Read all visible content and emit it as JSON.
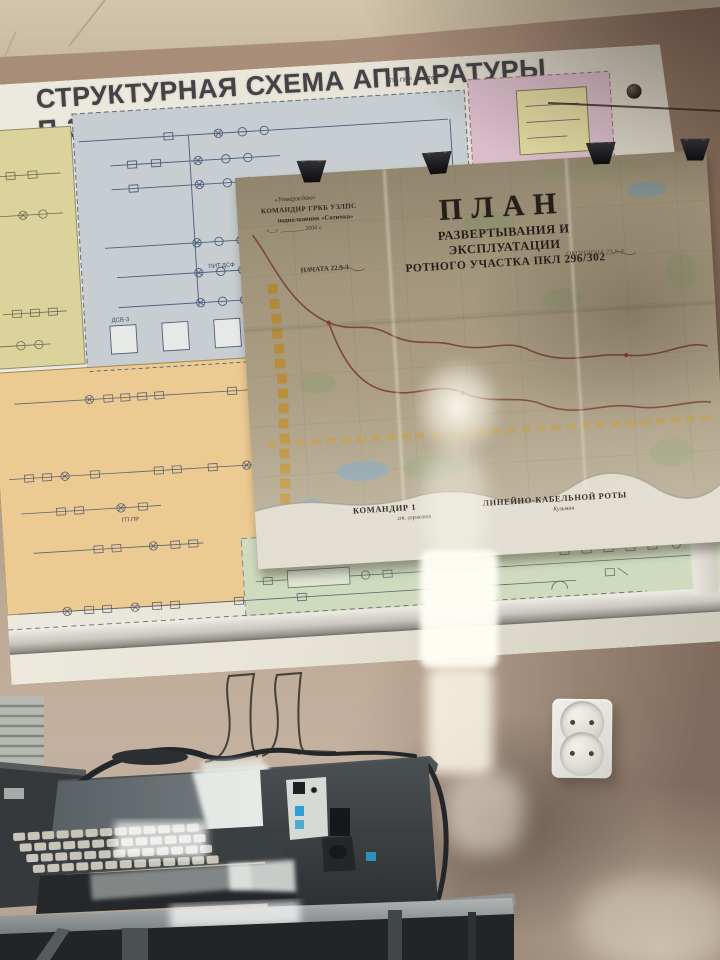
{
  "board": {
    "title": "СТРУКТУРНАЯ СХЕМА АППАРАТУРЫ П-302-О",
    "labels": {
      "pp_per_top": "ПП.ПЕР",
      "tf_top": "ТФ",
      "pit_dsf": "ПИТ.ДСФ",
      "dsv": "ДСВ-3",
      "gp_pr": "ГП.ПР",
      "vo12": "ВО-12"
    }
  },
  "map": {
    "approval": {
      "quote": "«Утверждаю»",
      "line1": "КОМАНДИР ГРКБ УЗЛПС",
      "line2": "подполковник  «Сотичка»",
      "line3": "«__» ________ 2004 г."
    },
    "title": "ПЛАН",
    "subtitle1": "РАЗВЕРТЫВАНИЯ И  ЭКСПЛУАТАЦИИ",
    "subtitle2": "РОТНОГО УЧАСТКА  ПКЛ 296/302",
    "started": "НАЧАТА 22.9-3",
    "finished": "ОКОНЧЕНА 23.9-3",
    "commander_role_1": "КОМАНДИР 1",
    "commander_role_2": "ЛИНЕЙНО-КАБЕЛЬНОЙ РОТЫ",
    "commander_rank": "ст. сержант",
    "commander_name": "Кузьмин"
  },
  "colors": {
    "panel_yellow": "#dbd29c",
    "panel_bluegray": "#c7cdd0",
    "panel_pink": "#d9bdc9",
    "panel_orange": "#eccb92",
    "panel_green": "#d0dabf",
    "map_paper": "#b0a389",
    "route_line": "#7b4034"
  }
}
